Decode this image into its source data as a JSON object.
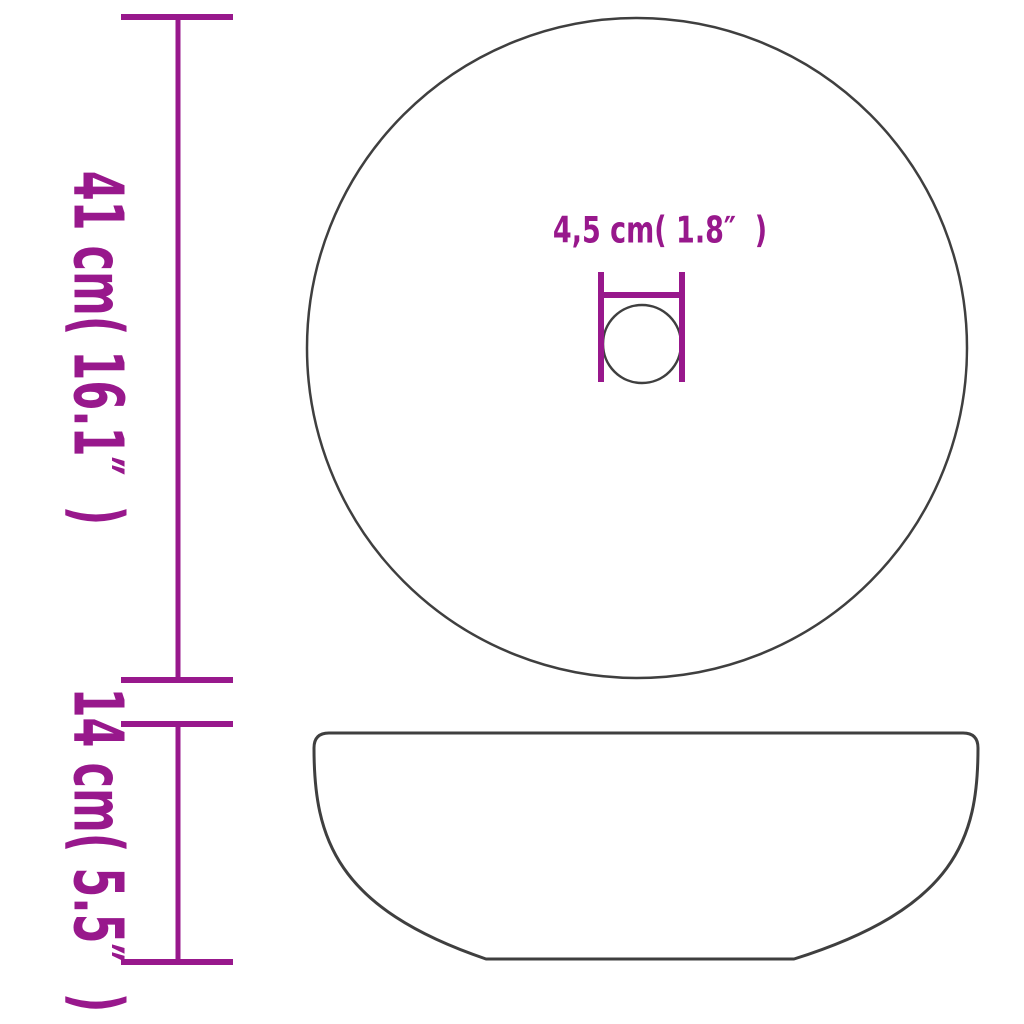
{
  "diagram": {
    "type": "product-dimension-diagram",
    "background": "#ffffff",
    "colors": {
      "dimension_lines_and_text": "#98188C",
      "product_outline": "#3F3F3F"
    },
    "labels": {
      "diameter": "41 cm( 16.1″  )",
      "height": "14 cm( 5.5″  )",
      "drain_diameter": "4,5 cm( 1.8″  )"
    },
    "measurements": [
      {
        "name": "basin-diameter",
        "cm": "41",
        "inches": "16.1"
      },
      {
        "name": "basin-height",
        "cm": "14",
        "inches": "5.5"
      },
      {
        "name": "drain-hole-diameter",
        "cm": "4,5",
        "inches": "1.8"
      }
    ]
  }
}
